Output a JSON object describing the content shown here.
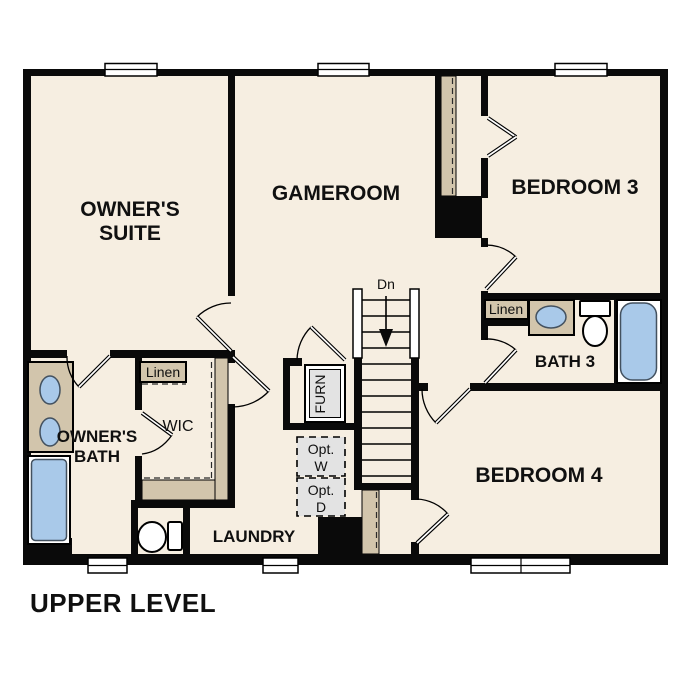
{
  "plan": {
    "title": "UPPER LEVEL",
    "level_name": "Upper Level Floor Plan"
  },
  "colors": {
    "floor": "#f6eee1",
    "wall": "#0a0a0a",
    "tan": "#d2c5ac",
    "fixture_blue": "#a9c9e9",
    "gray": "#e3e3e3"
  },
  "rooms": {
    "owners_suite": {
      "line1": "OWNER'S",
      "line2": "SUITE"
    },
    "gameroom": {
      "label": "GAMEROOM"
    },
    "bedroom3": {
      "label": "BEDROOM 3"
    },
    "bath3": {
      "label": "BATH 3"
    },
    "bedroom4": {
      "label": "BEDROOM 4"
    },
    "owners_bath": {
      "line1": "OWNER'S",
      "line2": "BATH"
    },
    "wic": {
      "label": "WIC"
    },
    "laundry": {
      "label": "LAUNDRY"
    }
  },
  "annotations": {
    "linen_wic": "Linen",
    "linen_bath3": "Linen",
    "stair_direction": "Dn",
    "furnace": "FURN",
    "opt_washer": {
      "line1": "Opt.",
      "line2": "W"
    },
    "opt_dryer": {
      "line1": "Opt.",
      "line2": "D"
    }
  }
}
